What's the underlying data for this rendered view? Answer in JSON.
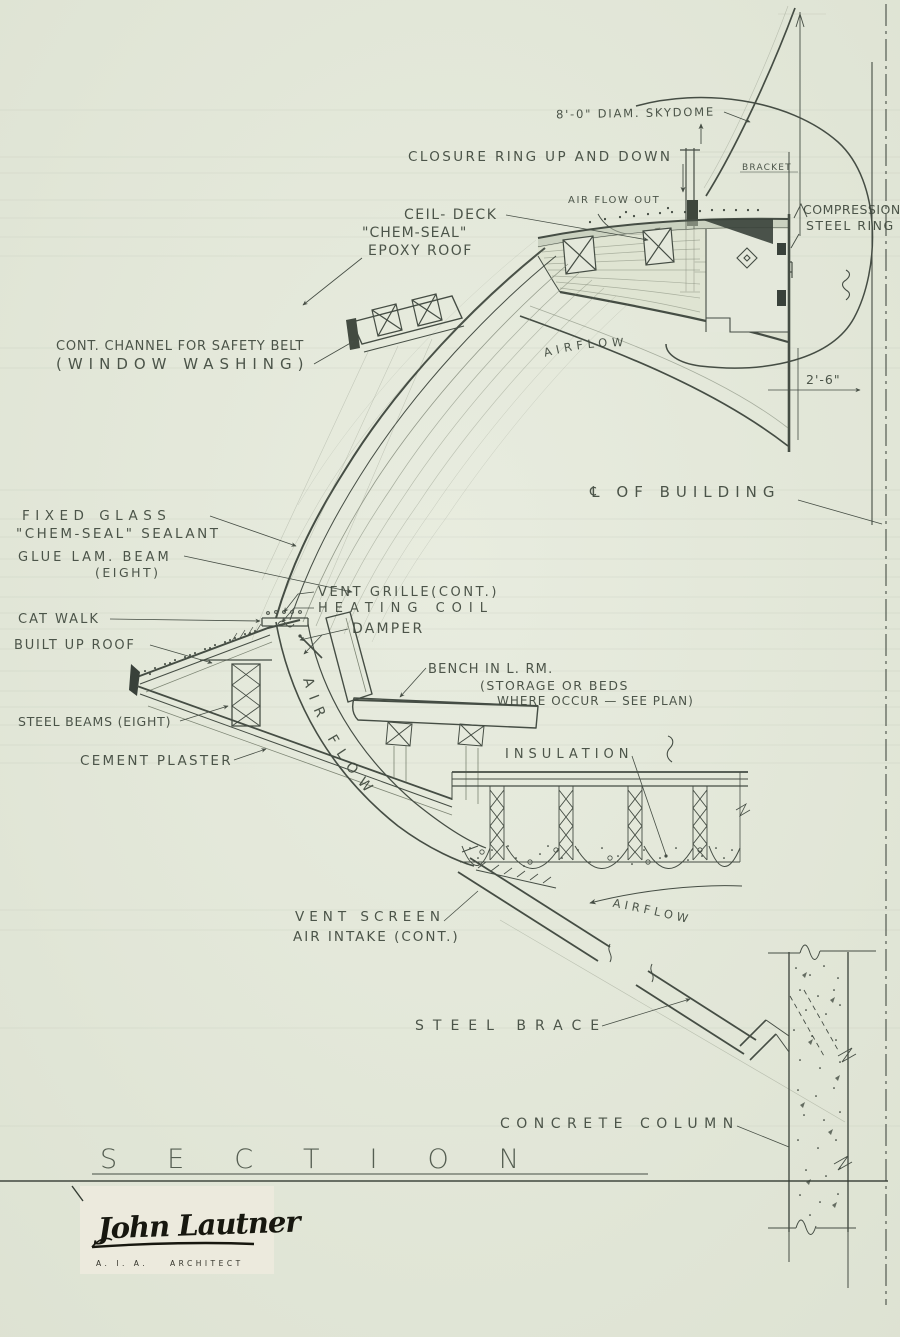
{
  "drawing": {
    "sheet_title": "SECTION",
    "annotations": {
      "skydome": "8'-0\" DIAM. SKYDOME",
      "closure_ring": "CLOSURE RING  UP AND DOWN",
      "air_flow_out": "AIR FLOW  OUT",
      "ceil_deck": "CEIL- DECK",
      "chem_seal": "\"CHEM-SEAL\"",
      "epoxy_roof": "EPOXY ROOF",
      "bracket": "BRACKET",
      "compression_line1": "COMPRESSION",
      "compression_line2": "STEEL RING",
      "safety_belt_line1": "CONT. CHANNEL FOR SAFETY BELT",
      "safety_belt_line2": "(WINDOW WASHING)",
      "airflow_upper": "AIRFLOW",
      "centerline": "℄ OF BUILDING",
      "fixed_glass_line1": "FIXED  GLASS",
      "fixed_glass_line2": "\"CHEM-SEAL\" SEALANT",
      "glue_lam_line1": "GLUE LAM. BEAM",
      "glue_lam_line2": "(EIGHT)",
      "vent_grille": "VENT GRILLE(CONT.)",
      "heating_coil": "HEATING COIL",
      "cat_walk": "CAT WALK",
      "damper": "DAMPER",
      "built_up_roof": "BUILT UP ROOF",
      "bench_line1": "BENCH IN L. RM.",
      "bench_line2": "(STORAGE OR BEDS",
      "bench_line3": "WHERE OCCUR — SEE PLAN)",
      "steel_beams": "STEEL BEAMS (EIGHT)",
      "cement_plaster": "CEMENT PLASTER",
      "insulation": "INSULATION",
      "air_flow_duct": "AIR FLOW",
      "vent_screen_line1": "VENT SCREEN",
      "vent_screen_line2": "AIR INTAKE (CONT.)",
      "airflow_lower": "AIRFLOW",
      "steel_brace": "STEEL BRACE",
      "concrete_column": "CONCRETE COLUMN"
    },
    "dimensions": {
      "skydome_edge_offset": "2'-6\""
    },
    "titleblock": {
      "signature": "John Lautner",
      "credential_org": "A. I. A.",
      "credential_role": "ARCHITECT"
    },
    "colors": {
      "paper": "#e4e8db",
      "ink": "#454d44",
      "ink_dark": "#343c33",
      "construction": "#7d8574",
      "signature_paper": "#eceadd"
    }
  }
}
